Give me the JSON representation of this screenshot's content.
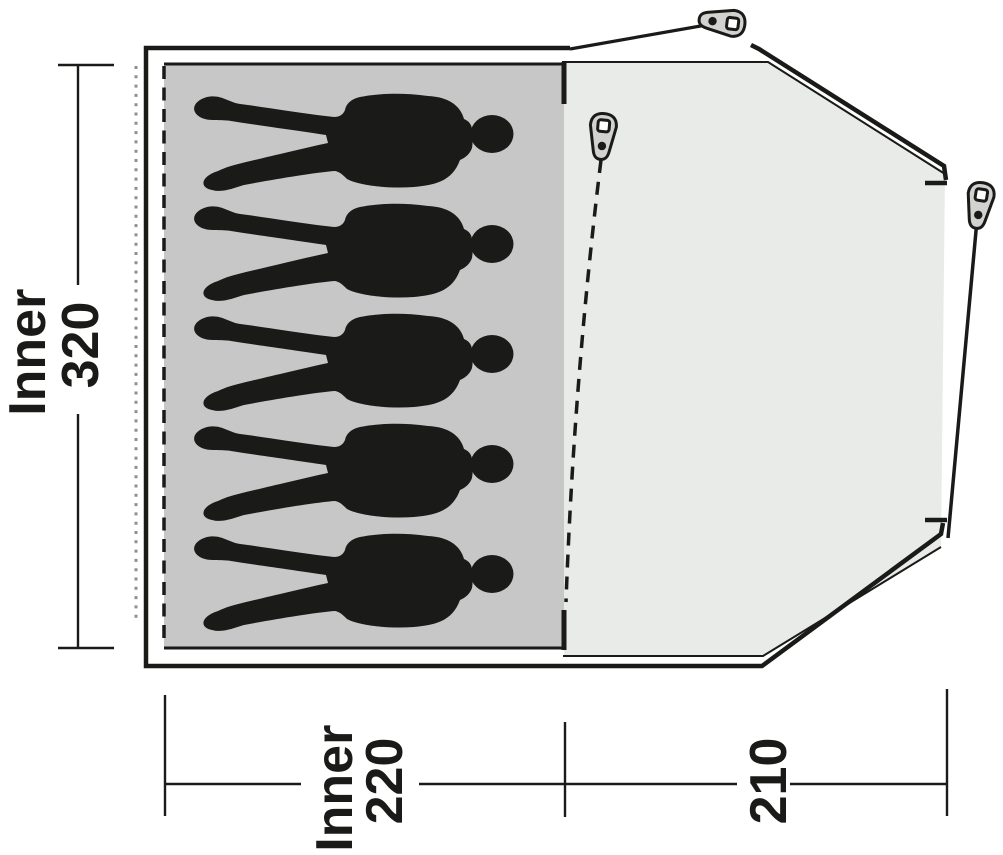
{
  "diagram": {
    "type": "tent-floorplan",
    "person_count": 5,
    "labels": {
      "inner_height": {
        "line1": "Inner",
        "line2": "320"
      },
      "inner_width": {
        "line1": "Inner",
        "line2": "220"
      },
      "porch_width": {
        "line1": "210"
      }
    },
    "icons": {
      "peg": "tent-peg-icon",
      "person": "person-silhouette"
    },
    "colors": {
      "inner_area": "#c6c7c6",
      "porch_area": "#e9ebe9",
      "line": "#1a1a18",
      "dotted_line": "#8f8f8f",
      "peg_fill": "#d2d2d0",
      "silhouette": "#1a1a18",
      "background": "#ffffff"
    }
  }
}
